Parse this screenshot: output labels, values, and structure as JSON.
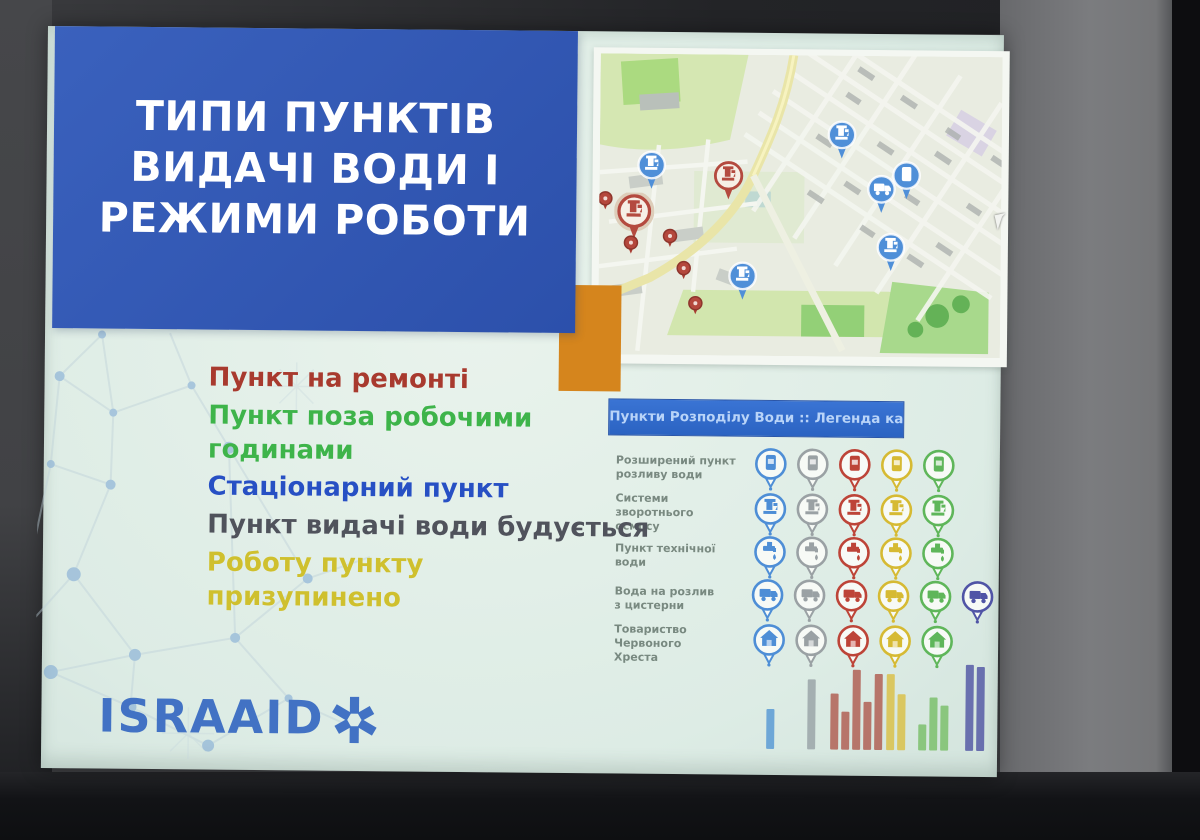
{
  "slide": {
    "title": {
      "lines": [
        "ТИПИ ПУНКТІВ",
        "ВИДАЧІ ВОДИ І",
        "РЕЖИМИ РОБОТИ"
      ],
      "bg_color": "#2e55b2",
      "text_color": "#ffffff"
    },
    "status_list": [
      {
        "label": "Пункт на ремонті",
        "color": "#a83a2e"
      },
      {
        "label": "Пункт поза робочими годинами",
        "color": "#3eb44a"
      },
      {
        "label": "Стаціонарний пункт",
        "color": "#2750c4"
      },
      {
        "label": "Пункт видачі води будується",
        "color": "#50535c"
      },
      {
        "label": "Роботу пункту призупинено",
        "color": "#cfc02e"
      }
    ],
    "legend": {
      "header": "Пункти Розподілу Води :: Легенда карти",
      "header_bg": "#2f6ace",
      "header_text_color": "#b9d4f8",
      "pin_colors": [
        "#4e8ed6",
        "#9aa1a4",
        "#bd4438",
        "#d6ba33",
        "#5fb65a",
        "#5054a6"
      ],
      "rows": [
        {
          "label": "Розширений пункт\nрозливу води",
          "icon": "dispenser-icon",
          "pin_count": 5
        },
        {
          "label": "Системи зворотнього\nосмосу",
          "icon": "pump-icon",
          "pin_count": 5
        },
        {
          "label": "Пункт технічної води",
          "icon": "tap-icon",
          "pin_count": 5
        },
        {
          "label": "Вода на розлив\nз цистерни",
          "icon": "truck-icon",
          "pin_count": 6
        },
        {
          "label": "Товариство Червоного\nХреста",
          "icon": "house-icon",
          "pin_count": 5
        }
      ],
      "footer_bars": [
        {
          "x": 725,
          "color": "#5b9bd5",
          "heights": [
            40
          ]
        },
        {
          "x": 766,
          "color": "#9aa5a8",
          "heights": [
            70
          ]
        },
        {
          "x": 789,
          "color": "#b06055",
          "heights": [
            56,
            38,
            80,
            48,
            76
          ]
        },
        {
          "x": 845,
          "color": "#d9c14a",
          "heights": [
            76,
            56
          ]
        },
        {
          "x": 877,
          "color": "#7cc06c",
          "heights": [
            26,
            53,
            45
          ]
        },
        {
          "x": 924,
          "color": "#565ba6",
          "heights": [
            86,
            84
          ]
        }
      ]
    },
    "map": {
      "pins": [
        {
          "type": "pump",
          "style": "blue",
          "x": 52,
          "y": 112
        },
        {
          "type": "pump",
          "style": "blue",
          "x": 242,
          "y": 80
        },
        {
          "type": "pump",
          "style": "blue",
          "x": 292,
          "y": 192
        },
        {
          "type": "pump",
          "style": "blue",
          "x": 144,
          "y": 222
        },
        {
          "type": "dispenser",
          "style": "blue",
          "x": 307,
          "y": 120
        },
        {
          "type": "truck",
          "style": "blue",
          "x": 282,
          "y": 134
        },
        {
          "type": "pump",
          "style": "red",
          "x": 129,
          "y": 122
        },
        {
          "type": "pump",
          "style": "red-large",
          "x": 35,
          "y": 159
        },
        {
          "type": "dot",
          "style": "dot",
          "x": 6,
          "y": 145
        },
        {
          "type": "dot",
          "style": "dot",
          "x": 32,
          "y": 189
        },
        {
          "type": "dot",
          "style": "dot",
          "x": 71,
          "y": 182
        },
        {
          "type": "dot",
          "style": "dot",
          "x": 85,
          "y": 214
        },
        {
          "type": "dot",
          "style": "dot",
          "x": 97,
          "y": 249
        }
      ],
      "pin_blue": "#4f8fd8",
      "pin_red": "#b44a3f"
    },
    "logo": {
      "text": "ISRAAID",
      "color": "#4272c4"
    }
  }
}
